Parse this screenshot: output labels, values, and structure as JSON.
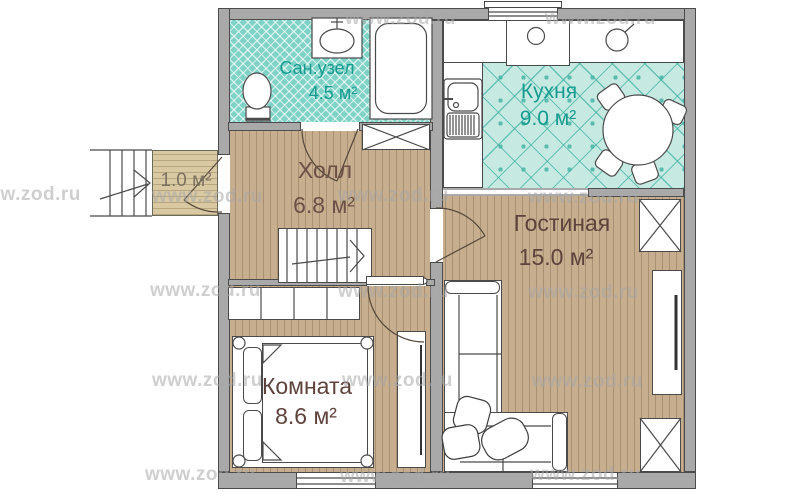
{
  "watermark": {
    "text": "www.zod.ru"
  },
  "rooms": {
    "bathroom": {
      "name": "Сан.узел",
      "area": "4.5 м²"
    },
    "kitchen": {
      "name": "Кухня",
      "area": "9.0 м²"
    },
    "hall": {
      "name": "Холл",
      "area": "6.8 м²"
    },
    "living_room": {
      "name": "Гостиная",
      "area": "15.0 м²"
    },
    "bedroom": {
      "name": "Комната",
      "area": "8.6 м²"
    },
    "porch": {
      "area": "1.0 м²"
    }
  },
  "colors": {
    "wall_fill": "#a9a9a9",
    "wood_floor": "#c6ae8e",
    "bathroom_tile": "#7ed2c6",
    "kitchen_tile": "#c6eae2",
    "porch_floor": "#d9c9a3",
    "teal_label": "#189c91",
    "brown_label": "#5e423c",
    "watermark_gray": "#a8a8a8"
  }
}
